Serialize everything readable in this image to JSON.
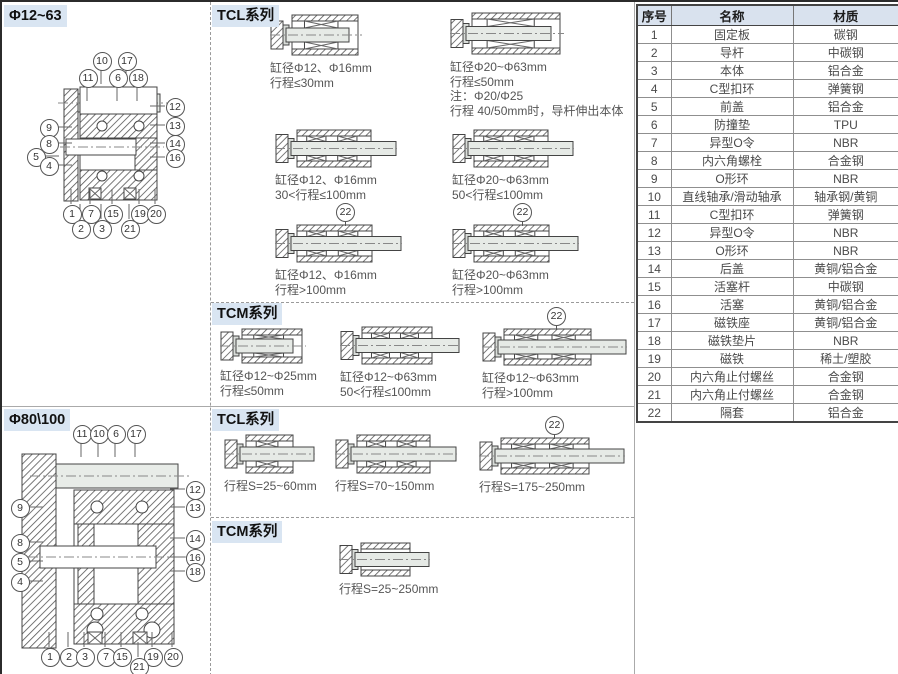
{
  "colors": {
    "header_bg": "#d9e5f2",
    "table_header_bg": "#d9e2ee",
    "line_gray": "#aaaaaa"
  },
  "left_top": {
    "title": "Φ12~63",
    "callouts": [
      {
        "n": "10",
        "x": 99,
        "y": 58
      },
      {
        "n": "17",
        "x": 124,
        "y": 58
      },
      {
        "n": "11",
        "x": 85,
        "y": 75
      },
      {
        "n": "6",
        "x": 115,
        "y": 75
      },
      {
        "n": "18",
        "x": 135,
        "y": 75
      },
      {
        "n": "12",
        "x": 172,
        "y": 104
      },
      {
        "n": "13",
        "x": 172,
        "y": 123
      },
      {
        "n": "14",
        "x": 172,
        "y": 141
      },
      {
        "n": "16",
        "x": 172,
        "y": 155
      },
      {
        "n": "9",
        "x": 46,
        "y": 125
      },
      {
        "n": "8",
        "x": 46,
        "y": 141
      },
      {
        "n": "5",
        "x": 33,
        "y": 154
      },
      {
        "n": "4",
        "x": 46,
        "y": 163
      },
      {
        "n": "1",
        "x": 69,
        "y": 211
      },
      {
        "n": "7",
        "x": 88,
        "y": 211
      },
      {
        "n": "15",
        "x": 110,
        "y": 211
      },
      {
        "n": "19",
        "x": 137,
        "y": 211
      },
      {
        "n": "20",
        "x": 153,
        "y": 211
      },
      {
        "n": "2",
        "x": 78,
        "y": 226
      },
      {
        "n": "3",
        "x": 99,
        "y": 226
      },
      {
        "n": "21",
        "x": 127,
        "y": 226
      }
    ]
  },
  "left_bottom": {
    "title": "Φ80\\100",
    "callouts": [
      {
        "n": "11",
        "x": 79,
        "y": 27
      },
      {
        "n": "10",
        "x": 96,
        "y": 27
      },
      {
        "n": "6",
        "x": 113,
        "y": 27
      },
      {
        "n": "17",
        "x": 133,
        "y": 27
      },
      {
        "n": "12",
        "x": 192,
        "y": 83
      },
      {
        "n": "13",
        "x": 192,
        "y": 101
      },
      {
        "n": "14",
        "x": 192,
        "y": 132
      },
      {
        "n": "16",
        "x": 192,
        "y": 151
      },
      {
        "n": "18",
        "x": 192,
        "y": 165
      },
      {
        "n": "9",
        "x": 17,
        "y": 101
      },
      {
        "n": "8",
        "x": 17,
        "y": 136
      },
      {
        "n": "5",
        "x": 17,
        "y": 155
      },
      {
        "n": "4",
        "x": 17,
        "y": 175
      },
      {
        "n": "1",
        "x": 47,
        "y": 250
      },
      {
        "n": "2",
        "x": 66,
        "y": 250
      },
      {
        "n": "3",
        "x": 82,
        "y": 250
      },
      {
        "n": "7",
        "x": 103,
        "y": 250
      },
      {
        "n": "15",
        "x": 119,
        "y": 250
      },
      {
        "n": "19",
        "x": 150,
        "y": 250
      },
      {
        "n": "20",
        "x": 170,
        "y": 250
      },
      {
        "n": "21",
        "x": 136,
        "y": 260
      }
    ]
  },
  "tcl_top": {
    "title": "TCL系列",
    "figs": [
      {
        "caption": [
          "缸径Φ12、Φ16mm",
          "行程≤30mm"
        ]
      },
      {
        "caption": [
          "缸径Φ20~Φ63mm",
          "行程≤50mm",
          "注：Φ20/Φ25",
          "行程 40/50mm时，导杆伸出本体"
        ]
      },
      {
        "caption": [
          "缸径Φ12、Φ16mm",
          "30<行程≤100mm"
        ]
      },
      {
        "caption": [
          "缸径Φ20~Φ63mm",
          "50<行程≤100mm"
        ]
      },
      {
        "callout": "22",
        "caption": [
          "缸径Φ12、Φ16mm",
          "行程>100mm"
        ]
      },
      {
        "callout": "22",
        "caption": [
          "缸径Φ20~Φ63mm",
          "行程>100mm"
        ]
      }
    ]
  },
  "tcm_top": {
    "title": "TCM系列",
    "figs": [
      {
        "caption": [
          "缸径Φ12~Φ25mm",
          "行程≤50mm"
        ]
      },
      {
        "caption": [
          "缸径Φ12~Φ63mm",
          "50<行程≤100mm"
        ]
      },
      {
        "callout": "22",
        "caption": [
          "缸径Φ12~Φ63mm",
          "行程>100mm"
        ]
      }
    ]
  },
  "tcl_bottom": {
    "title": "TCL系列",
    "figs": [
      {
        "caption": [
          "行程S=25~60mm"
        ]
      },
      {
        "caption": [
          "行程S=70~150mm"
        ]
      },
      {
        "callout": "22",
        "caption": [
          "行程S=175~250mm"
        ]
      }
    ]
  },
  "tcm_bottom": {
    "title": "TCM系列",
    "figs": [
      {
        "caption": [
          "行程S=25~250mm"
        ]
      }
    ]
  },
  "table": {
    "headers": [
      "序号",
      "名称",
      "材质"
    ],
    "rows": [
      [
        "1",
        "固定板",
        "碳钢"
      ],
      [
        "2",
        "导杆",
        "中碳钢"
      ],
      [
        "3",
        "本体",
        "铝合金"
      ],
      [
        "4",
        "C型扣环",
        "弹簧钢"
      ],
      [
        "5",
        "前盖",
        "铝合金"
      ],
      [
        "6",
        "防撞垫",
        "TPU"
      ],
      [
        "7",
        "异型O令",
        "NBR"
      ],
      [
        "8",
        "内六角螺栓",
        "合金钢"
      ],
      [
        "9",
        "O形环",
        "NBR"
      ],
      [
        "10",
        "直线轴承/滑动轴承",
        "轴承钢/黄铜"
      ],
      [
        "11",
        "C型扣环",
        "弹簧钢"
      ],
      [
        "12",
        "异型O令",
        "NBR"
      ],
      [
        "13",
        "O形环",
        "NBR"
      ],
      [
        "14",
        "后盖",
        "黄铜/铝合金"
      ],
      [
        "15",
        "活塞杆",
        "中碳钢"
      ],
      [
        "16",
        "活塞",
        "黄铜/铝合金"
      ],
      [
        "17",
        "磁铁座",
        "黄铜/铝合金"
      ],
      [
        "18",
        "磁铁垫片",
        "NBR"
      ],
      [
        "19",
        "磁铁",
        "稀土/塑胶"
      ],
      [
        "20",
        "内六角止付螺丝",
        "合金钢"
      ],
      [
        "21",
        "内六角止付螺丝",
        "合金钢"
      ],
      [
        "22",
        "隔套",
        "铝合金"
      ]
    ]
  }
}
